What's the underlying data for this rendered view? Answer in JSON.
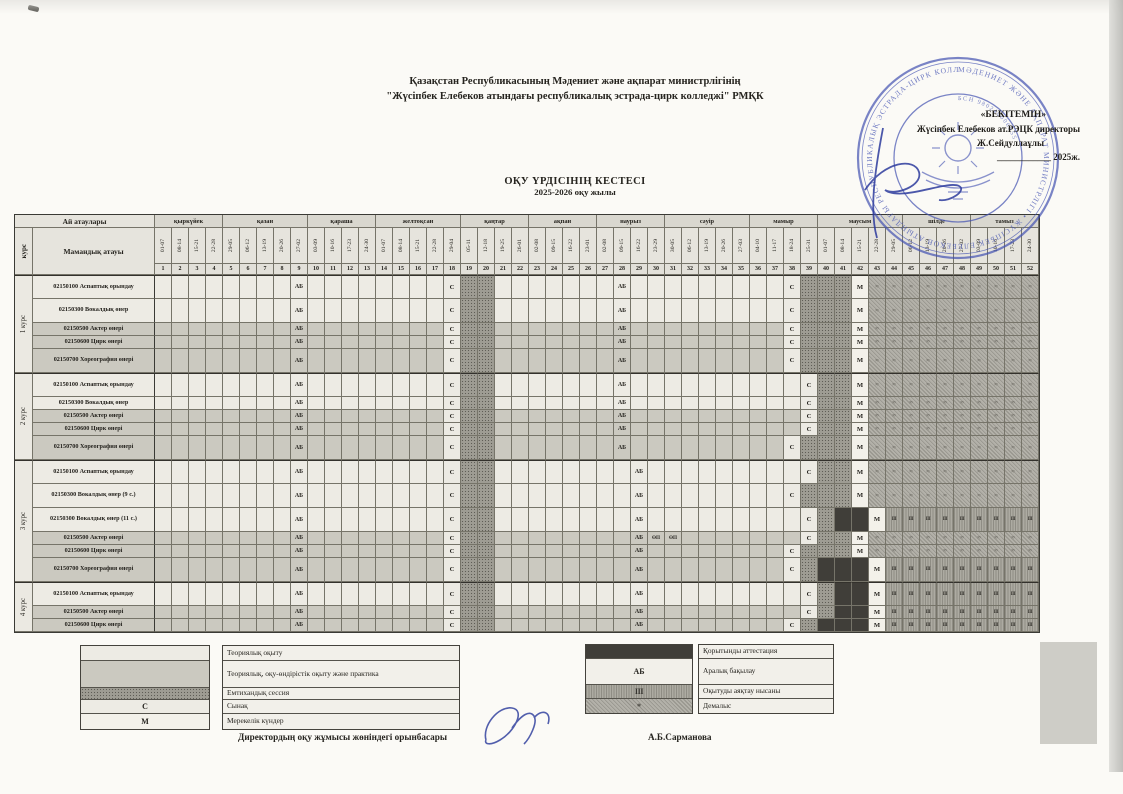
{
  "org_line1": "Қазақстан Республикасының Мәдениет және ақпарат министрлігінің",
  "org_line2": "\"Жүсіпбек Елебеков атындағы республикалық эстрада-цирк колледжі\" РМҚК",
  "title": "ОҚУ ҮРДІСІНІҢ КЕСТЕСІ",
  "subtitle": "2025-2026 оқу жылы",
  "approve": {
    "line1": "«БЕКІТЕМІН»",
    "line2": "Жүсіпбек Елебеков ат.РЭЦК директоры",
    "line3": "Ж.Сейдуллаұлы",
    "line4": "____________ 2025ж.",
    "stamp_ring": "МӘДЕНИЕТ ЖӘНЕ АҚПАРАТ МИНИСТРЛІГІ • ЖҮСІПБЕК ЕЛЕБЕКОВ АТЫНДАҒЫ РЕСПУБЛИКАЛЫҚ ЭСТРАДА-ЦИРК КОЛЛЕДЖІ •",
    "stamp_inner": "БСН 980240006555",
    "stamp_color": "#4352b2"
  },
  "table": {
    "corner_top": "Ай атаулары",
    "corner_course": "курс",
    "corner_specialty": "Мамандық атауы",
    "months": [
      {
        "name": "қыркүйек",
        "weeks": [
          "01-07",
          "08-14",
          "15-21",
          "22-28"
        ]
      },
      {
        "name": "қазан",
        "weeks": [
          "29-05",
          "06-12",
          "13-19",
          "20-26",
          "27-02"
        ]
      },
      {
        "name": "қараша",
        "weeks": [
          "03-09",
          "10-16",
          "17-23",
          "24-30"
        ]
      },
      {
        "name": "желтоқсан",
        "weeks": [
          "01-07",
          "08-14",
          "15-21",
          "22-28",
          "29-04"
        ]
      },
      {
        "name": "қаңтар",
        "weeks": [
          "05-11",
          "12-18",
          "19-25",
          "26-01"
        ]
      },
      {
        "name": "ақпан",
        "weeks": [
          "02-08",
          "09-15",
          "16-22",
          "23-01"
        ]
      },
      {
        "name": "наурыз",
        "weeks": [
          "02-08",
          "09-15",
          "16-22",
          "23-29"
        ]
      },
      {
        "name": "сәуір",
        "weeks": [
          "30-05",
          "06-12",
          "13-19",
          "20-26",
          "27-03"
        ]
      },
      {
        "name": "мамыр",
        "weeks": [
          "04-10",
          "11-17",
          "18-24",
          "25-31"
        ]
      },
      {
        "name": "маусым",
        "weeks": [
          "01-07",
          "08-14",
          "15-21",
          "22-28",
          "29-05"
        ]
      },
      {
        "name": "шілде",
        "weeks": [
          "06-12",
          "13-19",
          "20-26",
          "27-02"
        ]
      },
      {
        "name": "тамыз",
        "weeks": [
          "03-09",
          "10-16",
          "17-23",
          "24-30"
        ]
      }
    ],
    "codes": {
      "A": "АБ",
      "C": "С",
      "M": "М",
      "O": "ӨП",
      "V": "≈",
      "F": "ІІІ",
      "E": "",
      "T": "",
      "P": "",
      "K": ""
    },
    "courses": [
      {
        "name": "1 курс",
        "rows": [
          {
            "label": "02150100 Аспаптық орындау",
            "base": "T",
            "tall": true,
            "marks": "9:A,18:C,19-20:E,28:A,38:C,39-41:E,42:M,43-52:V"
          },
          {
            "label": "02150300 Вокалдық өнер",
            "base": "T",
            "tall": true,
            "marks": "9:A,18:C,19-20:E,28:A,38:C,39-41:E,42:M,43-52:V"
          },
          {
            "label": "02150500 Актер өнері",
            "base": "P",
            "tall": false,
            "marks": "9:A,18:C,19-20:E,28:A,38:C,39-41:E,42:M,43-52:V"
          },
          {
            "label": "02150600 Цирк өнері",
            "base": "P",
            "tall": false,
            "marks": "9:A,18:C,19-20:E,28:A,38:C,39-41:E,42:M,43-52:V"
          },
          {
            "label": "02150700 Хореография өнері",
            "base": "P",
            "tall": true,
            "marks": "9:A,18:C,19-20:E,28:A,38:C,39-41:E,42:M,43-52:V"
          }
        ]
      },
      {
        "name": "2 курс",
        "rows": [
          {
            "label": "02150100 Аспаптық орындау",
            "base": "T",
            "tall": true,
            "marks": "9:A,18:C,19-20:E,28:A,39:C,40-41:E,42:M,43-52:V"
          },
          {
            "label": "02150300 Вокалдық өнер",
            "base": "T",
            "tall": false,
            "marks": "9:A,18:C,19-20:E,28:A,39:C,40-41:E,42:M,43-52:V"
          },
          {
            "label": "02150500 Актер өнері",
            "base": "P",
            "tall": false,
            "marks": "9:A,18:C,19-20:E,28:A,39:C,40-41:E,42:M,43-52:V"
          },
          {
            "label": "02150600 Цирк өнері",
            "base": "P",
            "tall": false,
            "marks": "9:A,18:C,19-20:E,28:A,39:C,40-41:E,42:M,43-52:V"
          },
          {
            "label": "02150700 Хореография өнері",
            "base": "P",
            "tall": true,
            "marks": "9:A,18:C,19-20:E,28:A,38:C,39-41:E,42:M,43-52:V"
          }
        ]
      },
      {
        "name": "3 курс",
        "rows": [
          {
            "label": "02150100 Аспаптық орындау",
            "base": "T",
            "tall": true,
            "marks": "9:A,18:C,19-20:E,29:A,39:C,40-41:E,42:M,43-52:V"
          },
          {
            "label": "02150300 Вокалдық өнер (9 с.)",
            "base": "T",
            "tall": true,
            "marks": "9:A,18:C,19-20:E,29:A,38:C,39-41:E,42:M,43-52:V"
          },
          {
            "label": "02150300 Вокалдық өнер (11 с.)",
            "base": "T",
            "tall": true,
            "marks": "9:A,18:C,19-20:E,29:A,39:C,40:E,41-42:K,43:M,44-52:F"
          },
          {
            "label": "02150500 Актер өнері",
            "base": "P",
            "tall": false,
            "marks": "9:A,18:C,19-20:E,29:A,30:O,31:O,39:C,40-41:E,42:M,43-52:V"
          },
          {
            "label": "02150600 Цирк өнері",
            "base": "P",
            "tall": false,
            "marks": "9:A,18:C,19-20:E,29:A,38:C,39-41:E,42:M,43-52:V"
          },
          {
            "label": "02150700 Хореография өнері",
            "base": "P",
            "tall": true,
            "marks": "9:A,18:C,19-20:E,29:A,38:C,39:E,40-42:K,43:M,44-52:F"
          }
        ]
      },
      {
        "name": "4 курс",
        "rows": [
          {
            "label": "02150100 Аспаптық орындау",
            "base": "T",
            "tall": true,
            "marks": "9:A,18:C,19-20:E,29:A,39:C,40:E,41-42:K,43:M,44-52:F"
          },
          {
            "label": "02150500 Актер өнері",
            "base": "P",
            "tall": false,
            "marks": "9:A,18:C,19-20:E,29:A,39:C,40:E,41-42:K,43:M,44-52:F"
          },
          {
            "label": "02150600 Цирк өнері",
            "base": "P",
            "tall": false,
            "marks": "9:A,18:C,19-20:E,29:A,38:C,39:E,40-42:K,43:M,44-52:F"
          }
        ]
      }
    ]
  },
  "legend_left": [
    {
      "code": "T",
      "sym": "",
      "label": "Теориялық оқыту"
    },
    {
      "code": "P",
      "sym": "",
      "label": "Теориялық, оқу-өндірістік оқыту және практика"
    },
    {
      "code": "E",
      "sym": "",
      "label": "Емтихандық сессия"
    },
    {
      "code": "C",
      "sym": "С",
      "label": "Сынақ"
    },
    {
      "code": "M",
      "sym": "М",
      "label": "Мерекелік күндер"
    }
  ],
  "legend_right": [
    {
      "code": "K",
      "sym": "",
      "label": "Қорытынды аттестация"
    },
    {
      "code": "W",
      "sym": "АБ",
      "label": "Аралық бақылау"
    },
    {
      "code": "F",
      "sym": "ІІІ",
      "label": "Оқытуды аяқтау нысаны"
    },
    {
      "code": "V",
      "sym": "*",
      "label": "Демалыс"
    }
  ],
  "footer": {
    "position": "Директордың оқу жұмысы жөніндегі орынбасары",
    "name": "А.Б.Сарманова"
  }
}
